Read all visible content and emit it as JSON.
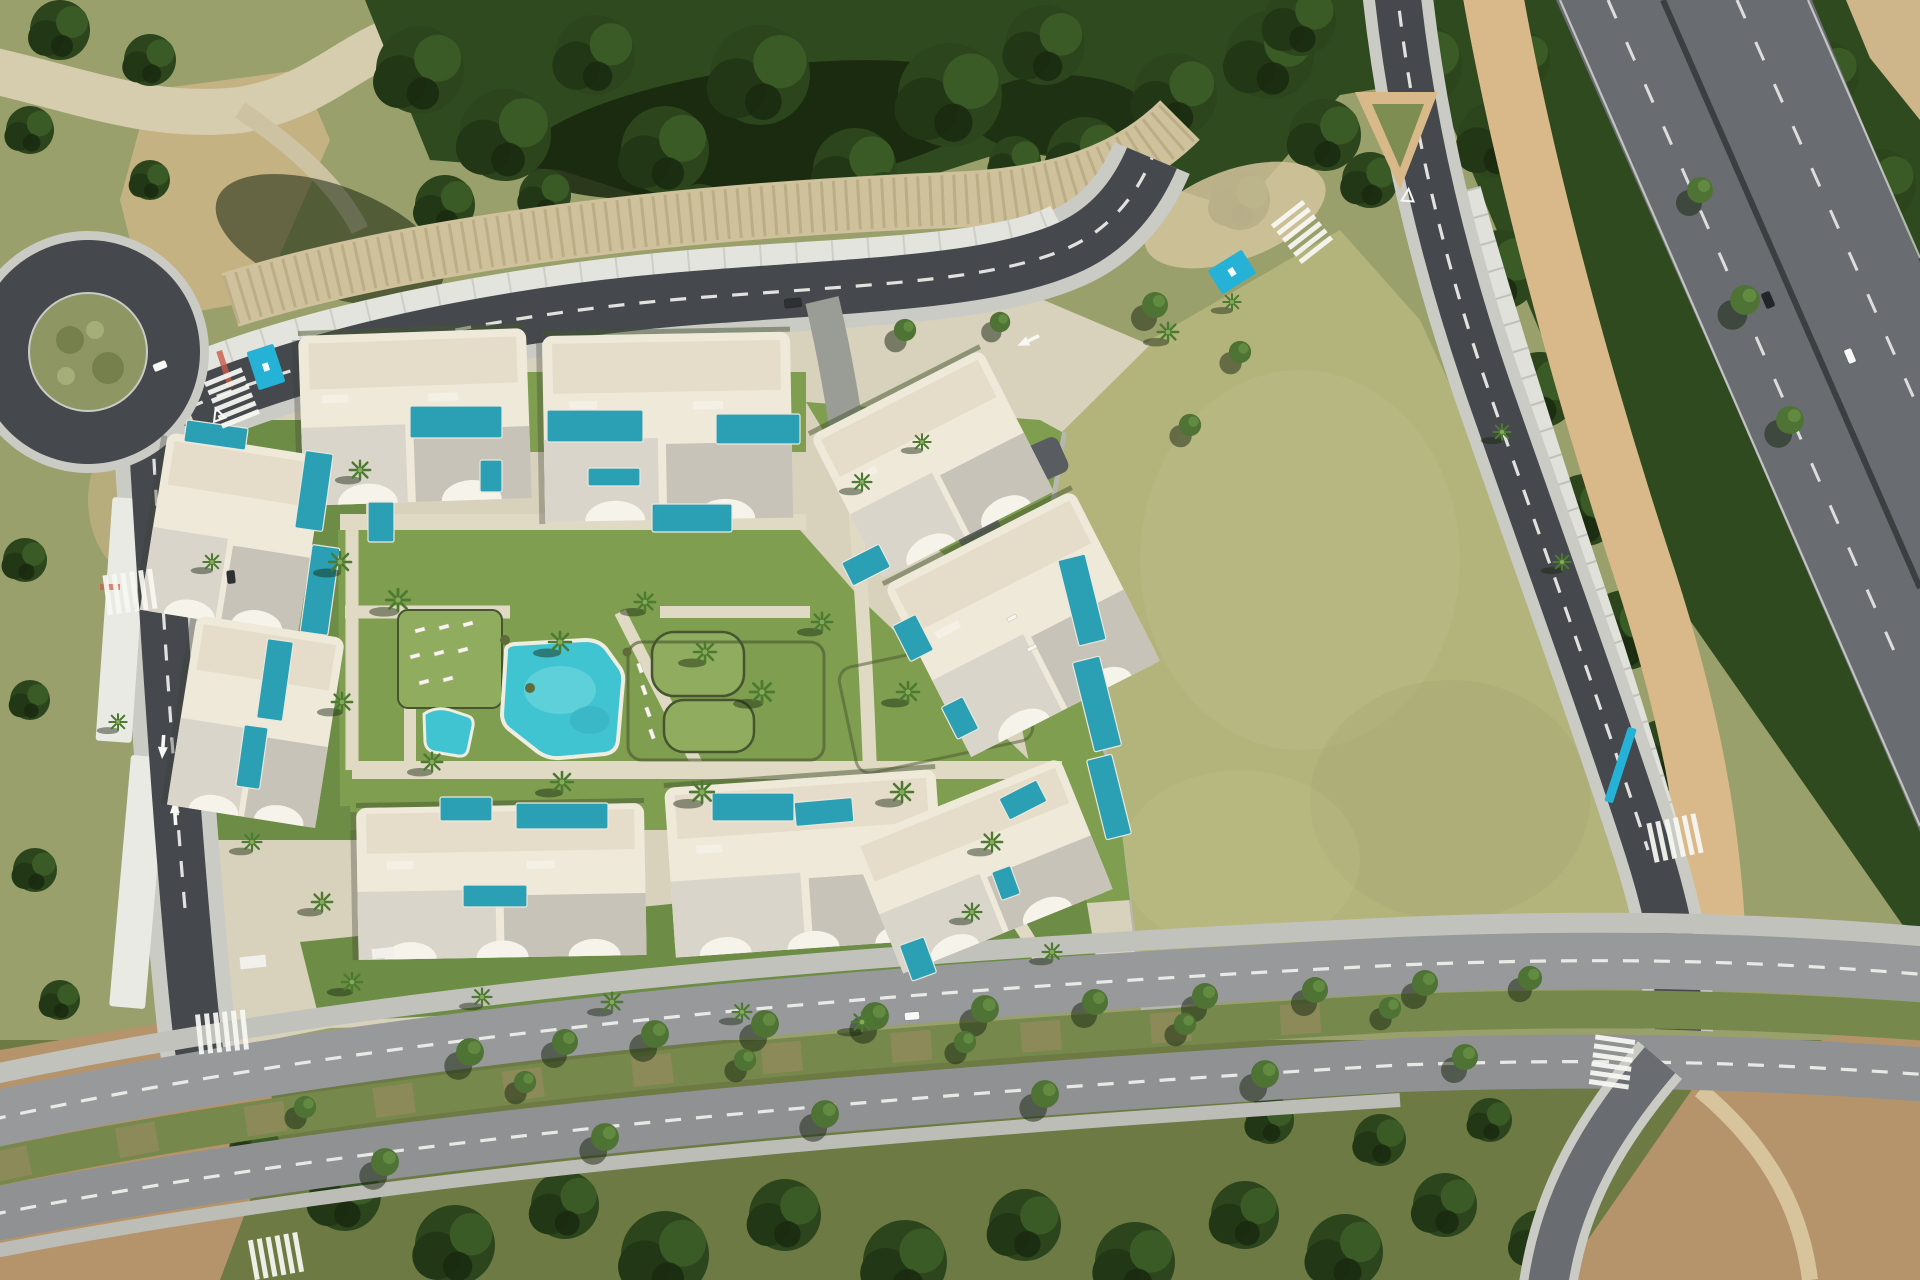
{
  "palette": {
    "asphalt": "#45484c",
    "asphalt_light": "#696c70",
    "road_mark": "#f2f2ee",
    "sidewalk": "#cbcbc6",
    "sidewalk_dark": "#b4b4ae",
    "tan_walk": "#d9b98a",
    "parking_strip": "#e4e4df",
    "forest": "#304a20",
    "forest_dark": "#18260e",
    "forest_mid": "#3e5c29",
    "scrub": "#99a06b",
    "scrub_light": "#b3b383",
    "dirt": "#b5946c",
    "dirt_light": "#cfb68a",
    "rock": "#cec19b",
    "field": "#b3b37c",
    "field_light": "#c0c08b",
    "plot": "#d8d1bb",
    "path": "#e0d9c3",
    "lawn": "#7f9e50",
    "lawn_light": "#90ad5f",
    "lawn_dark": "#6d8c45",
    "hedge": "#46552f",
    "building": "#efe9da",
    "building_white": "#f6f3ea",
    "roof": "#c7c3b9",
    "roof_light": "#d9d5ca",
    "deck": "#e5ddc9",
    "pool": "#2ba0b4",
    "pool_bright": "#41c4d2",
    "pool_light": "#7adbe2",
    "handicap": "#25b2d6",
    "median": "#77884d",
    "median_dirt": "#9d8c63",
    "car_black": "#23262a",
    "car_white": "#f8f8f6",
    "car_dark": "#2e3134"
  },
  "scene": {
    "labels": {
      "scene": "aerial-view-residential-development",
      "development": "villa-complex-with-private-pools",
      "garden": "communal-garden-and-pool",
      "field": "vacant-grass-parcel",
      "highway": "dual-carriageway-highway",
      "boulevard": "tree-lined-avenue",
      "roundabout": "roundabout",
      "access_road": "main-access-road",
      "side_road": "perimeter-road-with-carports"
    },
    "counts": {
      "building_clusters": 8,
      "private_pools": 26,
      "communal_pools": 1,
      "kids_pools": 1,
      "roundabouts": 1,
      "pedestrian_crossings": 7,
      "vehicles": 6,
      "handicap_bays": 2
    }
  },
  "trees_back": [
    [
      420,
      70,
      44
    ],
    [
      505,
      135,
      46
    ],
    [
      595,
      55,
      40
    ],
    [
      665,
      150,
      44
    ],
    [
      760,
      75,
      50
    ],
    [
      855,
      170,
      42
    ],
    [
      950,
      95,
      52
    ],
    [
      1045,
      45,
      40
    ],
    [
      1085,
      155,
      38
    ],
    [
      1175,
      95,
      42
    ],
    [
      1270,
      55,
      44
    ],
    [
      1325,
      135,
      36
    ],
    [
      1420,
      65,
      42
    ],
    [
      1495,
      140,
      38
    ],
    [
      445,
      205,
      30
    ],
    [
      700,
      212,
      28
    ],
    [
      885,
      198,
      26
    ],
    [
      1015,
      162,
      26
    ],
    [
      545,
      195,
      26
    ],
    [
      1240,
      200,
      30
    ],
    [
      1300,
      20,
      36
    ],
    [
      1370,
      180,
      28
    ],
    [
      60,
      30,
      30
    ],
    [
      150,
      60,
      26
    ],
    [
      30,
      130,
      24
    ],
    [
      95,
      330,
      22
    ],
    [
      40,
      420,
      24
    ],
    [
      25,
      560,
      22
    ],
    [
      30,
      700,
      20
    ],
    [
      150,
      180,
      20
    ],
    [
      1520,
      60,
      30
    ],
    [
      1500,
      270,
      40
    ],
    [
      1540,
      390,
      38
    ],
    [
      1585,
      510,
      36
    ],
    [
      1625,
      630,
      40
    ],
    [
      1665,
      755,
      36
    ],
    [
      1700,
      870,
      30
    ],
    [
      1760,
      140,
      30
    ],
    [
      1825,
      75,
      34
    ],
    [
      1880,
      185,
      36
    ],
    [
      1855,
      325,
      30
    ],
    [
      1900,
      450,
      28
    ],
    [
      1905,
      585,
      26
    ],
    [
      1845,
      260,
      26
    ],
    [
      345,
      1195,
      36
    ],
    [
      455,
      1245,
      40
    ],
    [
      565,
      1205,
      34
    ],
    [
      665,
      1255,
      44
    ],
    [
      785,
      1215,
      36
    ],
    [
      905,
      1262,
      42
    ],
    [
      1025,
      1225,
      36
    ],
    [
      1135,
      1262,
      40
    ],
    [
      1245,
      1215,
      34
    ],
    [
      1345,
      1252,
      38
    ],
    [
      1445,
      1205,
      32
    ],
    [
      1540,
      1240,
      30
    ],
    [
      255,
      1150,
      26
    ],
    [
      1270,
      1120,
      24
    ],
    [
      1380,
      1140,
      26
    ],
    [
      1490,
      1120,
      22
    ],
    [
      35,
      870,
      22
    ],
    [
      60,
      1000,
      20
    ]
  ],
  "trees_front": [
    [
      470,
      1052,
      15,
      "t"
    ],
    [
      565,
      1042,
      14,
      "t"
    ],
    [
      655,
      1034,
      15,
      "t"
    ],
    [
      765,
      1024,
      15,
      "t"
    ],
    [
      875,
      1016,
      15,
      "t"
    ],
    [
      985,
      1009,
      15,
      "t"
    ],
    [
      1095,
      1002,
      14,
      "t"
    ],
    [
      1205,
      996,
      14,
      "t"
    ],
    [
      1315,
      990,
      14,
      "t"
    ],
    [
      1425,
      983,
      14,
      "t"
    ],
    [
      1530,
      978,
      13,
      "t"
    ],
    [
      305,
      1107,
      12,
      "t"
    ],
    [
      525,
      1082,
      12,
      "t"
    ],
    [
      745,
      1060,
      12,
      "t"
    ],
    [
      965,
      1042,
      12,
      "t"
    ],
    [
      1185,
      1024,
      12,
      "t"
    ],
    [
      1390,
      1008,
      12,
      "t"
    ],
    [
      385,
      1162,
      15,
      "t"
    ],
    [
      605,
      1137,
      15,
      "t"
    ],
    [
      825,
      1114,
      15,
      "t"
    ],
    [
      1045,
      1094,
      15,
      "t"
    ],
    [
      1265,
      1074,
      15,
      "t"
    ],
    [
      1465,
      1057,
      14,
      "t"
    ],
    [
      905,
      330,
      12,
      "t"
    ],
    [
      1000,
      322,
      11,
      "t"
    ],
    [
      1155,
      305,
      14,
      "t"
    ],
    [
      1190,
      425,
      12,
      "t"
    ],
    [
      1240,
      352,
      12,
      "t"
    ],
    [
      1745,
      300,
      16,
      "t"
    ],
    [
      1790,
      420,
      15,
      "t"
    ],
    [
      1700,
      190,
      14,
      "t"
    ],
    [
      360,
      470,
      13,
      "p"
    ],
    [
      340,
      562,
      14,
      "p"
    ],
    [
      398,
      600,
      15,
      "p"
    ],
    [
      560,
      642,
      14,
      "p"
    ],
    [
      645,
      602,
      13,
      "p"
    ],
    [
      705,
      652,
      14,
      "p"
    ],
    [
      762,
      692,
      15,
      "p"
    ],
    [
      822,
      622,
      13,
      "p"
    ],
    [
      908,
      692,
      14,
      "p"
    ],
    [
      702,
      792,
      15,
      "p"
    ],
    [
      562,
      782,
      14,
      "p"
    ],
    [
      432,
      762,
      13,
      "p"
    ],
    [
      342,
      702,
      13,
      "p"
    ],
    [
      902,
      792,
      14,
      "p"
    ],
    [
      992,
      842,
      13,
      "p"
    ],
    [
      252,
      842,
      12,
      "p"
    ],
    [
      322,
      902,
      13,
      "p"
    ],
    [
      212,
      562,
      11,
      "p"
    ],
    [
      862,
      482,
      12,
      "p"
    ],
    [
      922,
      442,
      11,
      "p"
    ],
    [
      1168,
      332,
      13,
      "p"
    ],
    [
      1232,
      302,
      11,
      "p"
    ],
    [
      352,
      982,
      13,
      "p"
    ],
    [
      482,
      997,
      12,
      "p"
    ],
    [
      612,
      1002,
      13,
      "p"
    ],
    [
      742,
      1012,
      12,
      "p"
    ],
    [
      862,
      1022,
      13,
      "p"
    ],
    [
      118,
      722,
      11,
      "p"
    ],
    [
      1502,
      432,
      11,
      "p"
    ],
    [
      1562,
      562,
      11,
      "p"
    ],
    [
      972,
      912,
      12,
      "p"
    ],
    [
      1052,
      952,
      12,
      "p"
    ]
  ],
  "pools": [
    [
      410,
      406,
      92,
      32,
      0
    ],
    [
      547,
      410,
      96,
      32,
      0
    ],
    [
      716,
      414,
      84,
      30,
      0
    ],
    [
      480,
      460,
      22,
      32,
      0
    ],
    [
      368,
      502,
      26,
      40,
      0
    ],
    [
      652,
      504,
      80,
      28,
      0
    ],
    [
      588,
      468,
      52,
      18,
      0
    ],
    [
      300,
      452,
      28,
      78,
      8
    ],
    [
      306,
      546,
      28,
      88,
      8
    ],
    [
      262,
      640,
      26,
      80,
      8
    ],
    [
      240,
      726,
      24,
      62,
      8
    ],
    [
      185,
      424,
      62,
      22,
      8
    ],
    [
      440,
      797,
      52,
      24,
      0
    ],
    [
      516,
      803,
      92,
      26,
      0
    ],
    [
      463,
      885,
      64,
      22,
      0
    ],
    [
      712,
      793,
      82,
      28,
      0
    ],
    [
      795,
      800,
      58,
      24,
      -5
    ],
    [
      1068,
      556,
      28,
      88,
      -14
    ],
    [
      1083,
      658,
      28,
      92,
      -14
    ],
    [
      1096,
      756,
      26,
      82,
      -14
    ],
    [
      845,
      552,
      42,
      26,
      -27
    ],
    [
      900,
      618,
      26,
      40,
      -27
    ],
    [
      948,
      700,
      24,
      36,
      -27
    ],
    [
      1002,
      788,
      42,
      24,
      -27
    ],
    [
      905,
      940,
      26,
      38,
      -20
    ],
    [
      996,
      868,
      20,
      30,
      -20
    ]
  ],
  "crosswalks": [
    [
      232,
      398,
      -22
    ],
    [
      130,
      592,
      82
    ],
    [
      1302,
      232,
      -38
    ],
    [
      1675,
      838,
      78
    ],
    [
      222,
      1032,
      84
    ],
    [
      1612,
      1062,
      8
    ],
    [
      276,
      1256,
      80
    ]
  ],
  "handicap_spots": [
    [
      252,
      347,
      28,
      40,
      -18
    ],
    [
      1212,
      258,
      40,
      28,
      -32
    ],
    [
      1616,
      726,
      9,
      78,
      18
    ]
  ],
  "cars": [
    [
      1768,
      300,
      16,
      9,
      67,
      "black"
    ],
    [
      1850,
      356,
      15,
      8,
      67,
      "white"
    ],
    [
      912,
      1016,
      15,
      8,
      -5,
      "white"
    ],
    [
      793,
      303,
      17,
      9,
      -6,
      "dark"
    ],
    [
      160,
      366,
      14,
      8,
      -22,
      "white"
    ],
    [
      231,
      577,
      13,
      8,
      84,
      "dark"
    ]
  ],
  "loungers": [
    [
      420,
      630,
      -15
    ],
    [
      444,
      627,
      -15
    ],
    [
      468,
      624,
      -15
    ],
    [
      415,
      656,
      -15
    ],
    [
      439,
      653,
      -15
    ],
    [
      463,
      650,
      -15
    ],
    [
      424,
      682,
      -15
    ],
    [
      448,
      679,
      -15
    ],
    [
      640,
      668,
      70
    ],
    [
      644,
      690,
      70
    ],
    [
      648,
      712,
      70
    ],
    [
      652,
      734,
      70
    ],
    [
      1012,
      618,
      -27
    ],
    [
      1032,
      648,
      -27
    ]
  ]
}
